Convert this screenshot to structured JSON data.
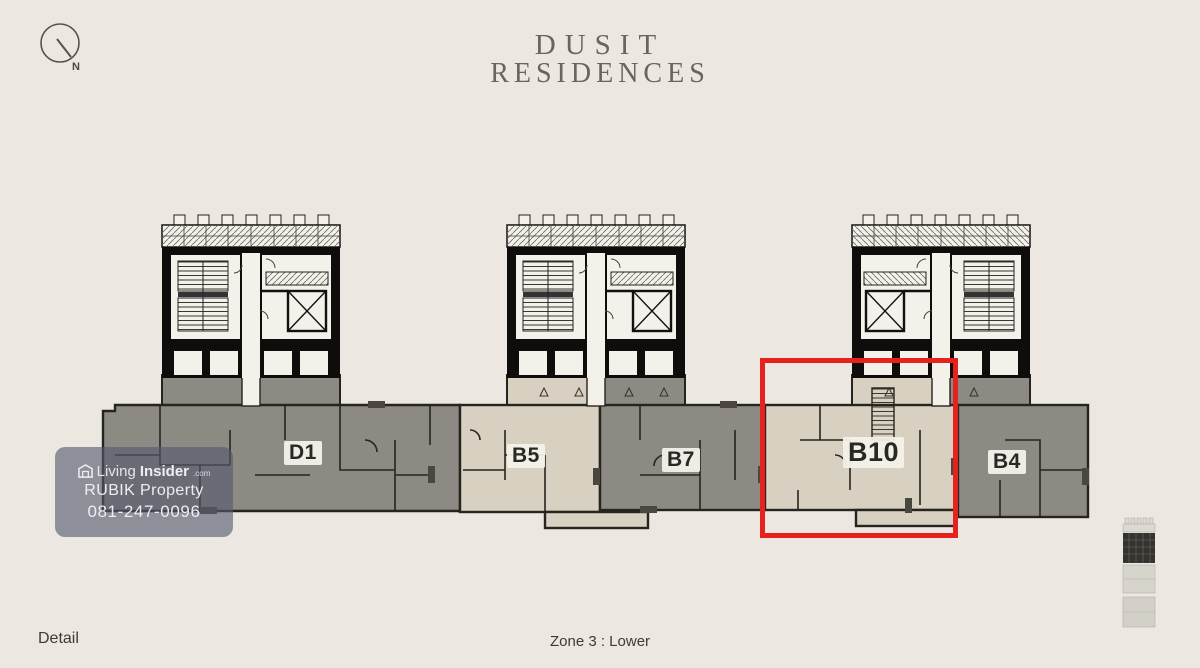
{
  "title": {
    "line1": "DUSIT",
    "line2": "RESIDENCES"
  },
  "compass": {
    "north_label": "N"
  },
  "plan": {
    "highlighted_unit": "B10",
    "highlight_color": "#e7211d",
    "unit_gray_color": "#8d8a84",
    "unit_beige_color": "#d8d1c2",
    "units": [
      {
        "id": "D1",
        "label": "D1",
        "fill": "gray"
      },
      {
        "id": "B5",
        "label": "B5",
        "fill": "beige"
      },
      {
        "id": "B7",
        "label": "B7",
        "fill": "gray"
      },
      {
        "id": "B10",
        "label": "B10",
        "fill": "beige"
      },
      {
        "id": "B4",
        "label": "B4",
        "fill": "gray"
      }
    ]
  },
  "watermark": {
    "brand_prefix": "Living",
    "brand_suffix": "Insider",
    "brand_tld": ".com",
    "company": "RUBIK Property",
    "phone": "081-247-0096"
  },
  "footer": {
    "left_label": "Detail",
    "center_label": "Zone 3 : Lower"
  }
}
